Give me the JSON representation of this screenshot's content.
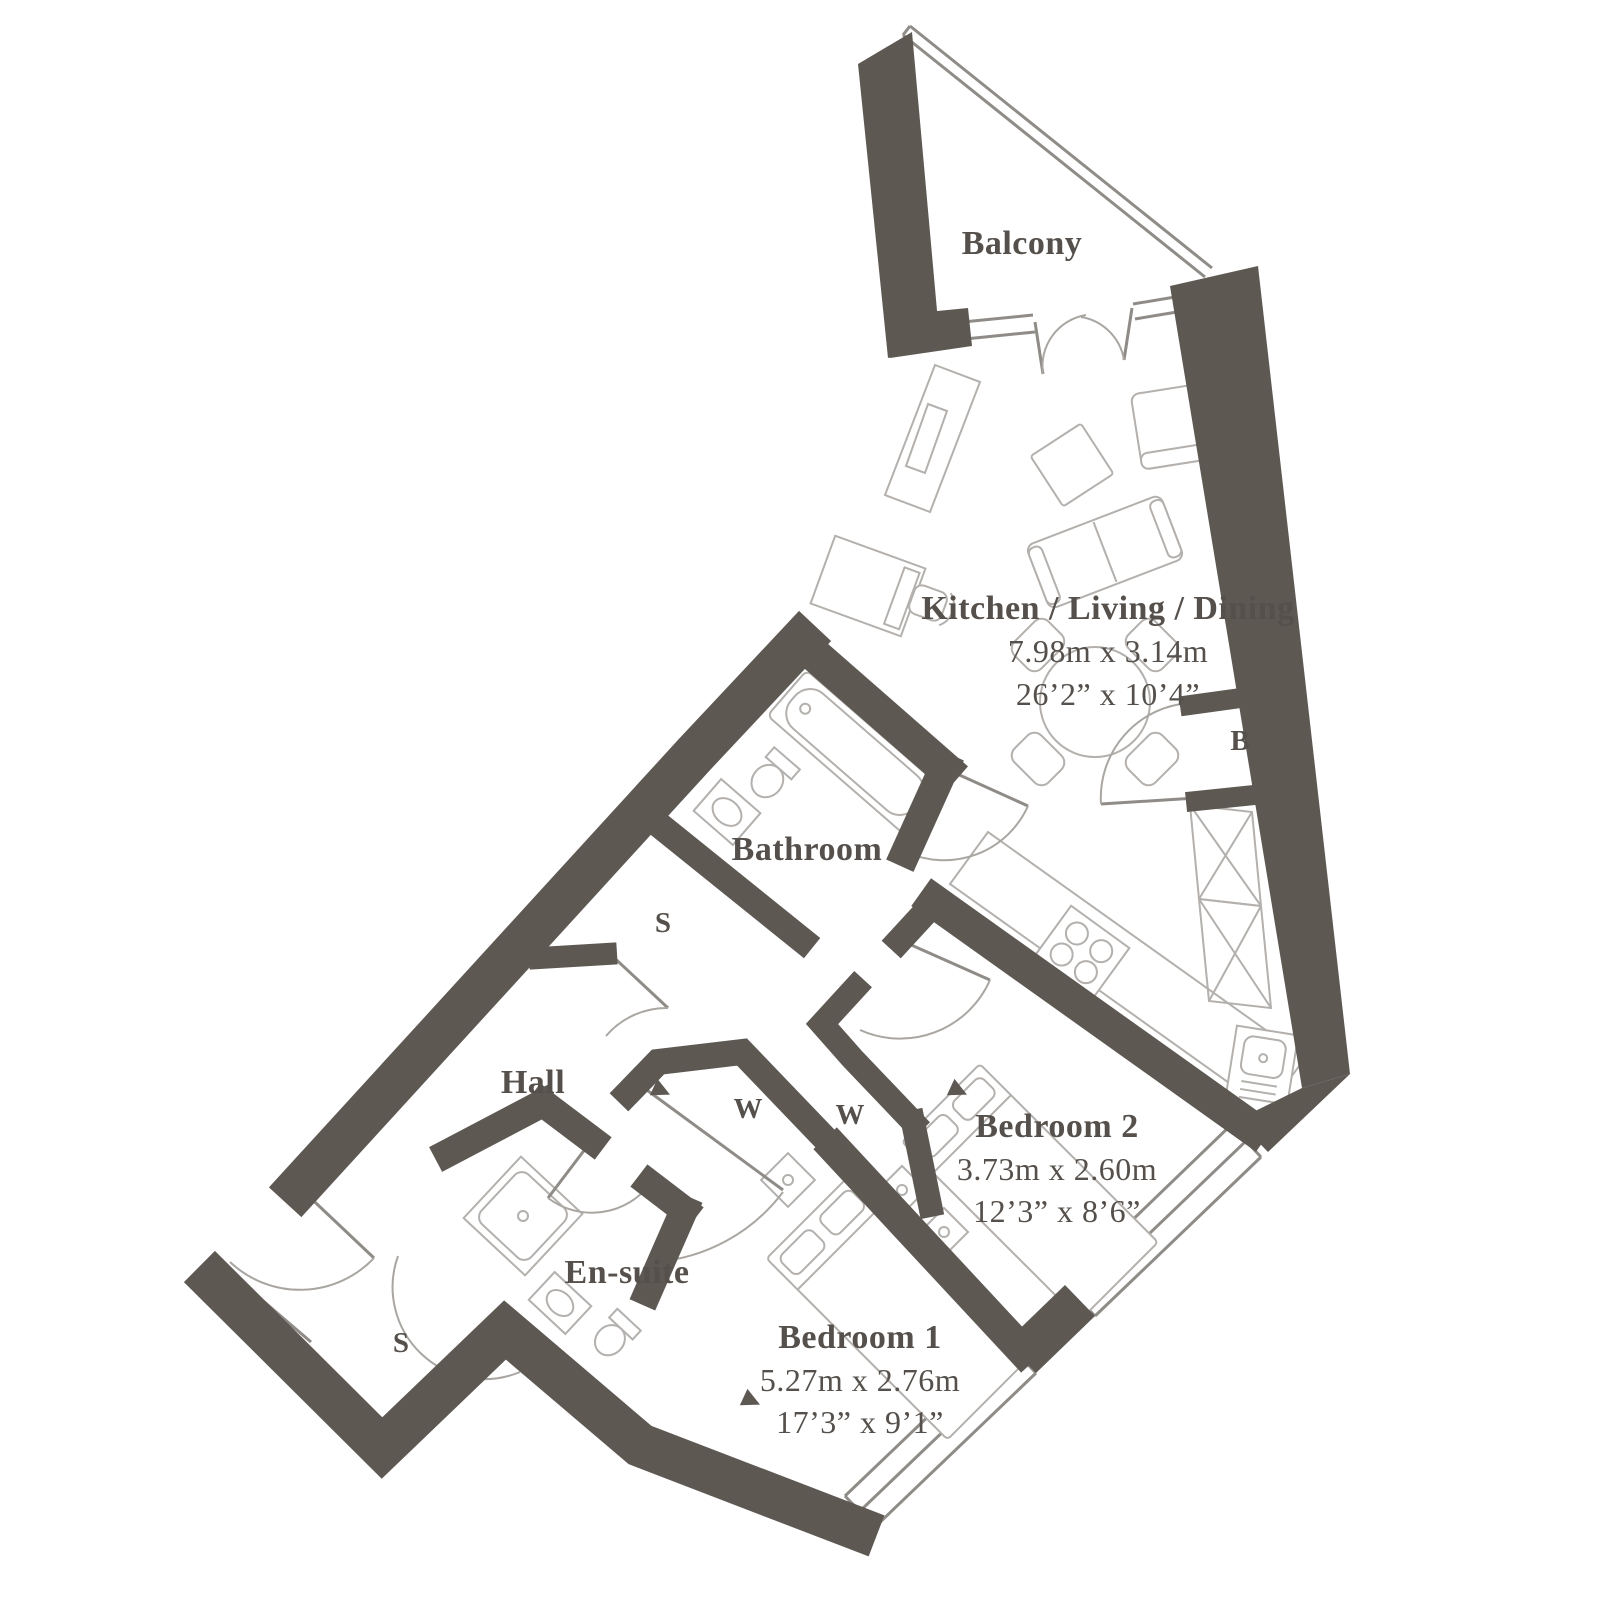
{
  "plan": {
    "rooms": {
      "balcony": {
        "name": "Balcony"
      },
      "kld": {
        "name": "Kitchen / Living / Dining",
        "metric": "7.98m x 3.14m",
        "imperial": "26’2” x 10’4”"
      },
      "bathroom": {
        "name": "Bathroom"
      },
      "hall": {
        "name": "Hall"
      },
      "ensuite": {
        "name": "En-suite"
      },
      "bedroom1": {
        "name": "Bedroom 1",
        "metric": "5.27m x 2.76m",
        "imperial": "17’3” x 9’1”"
      },
      "bedroom2": {
        "name": "Bedroom 2",
        "metric": "3.73m x 2.60m",
        "imperial": "12’3” x 8’6”"
      }
    },
    "markers": {
      "store": "S",
      "wardrobe": "W",
      "boiler": "B"
    },
    "colors": {
      "wall": "#5e5853",
      "line": "#b3b0ad",
      "text": "#55504b"
    }
  }
}
